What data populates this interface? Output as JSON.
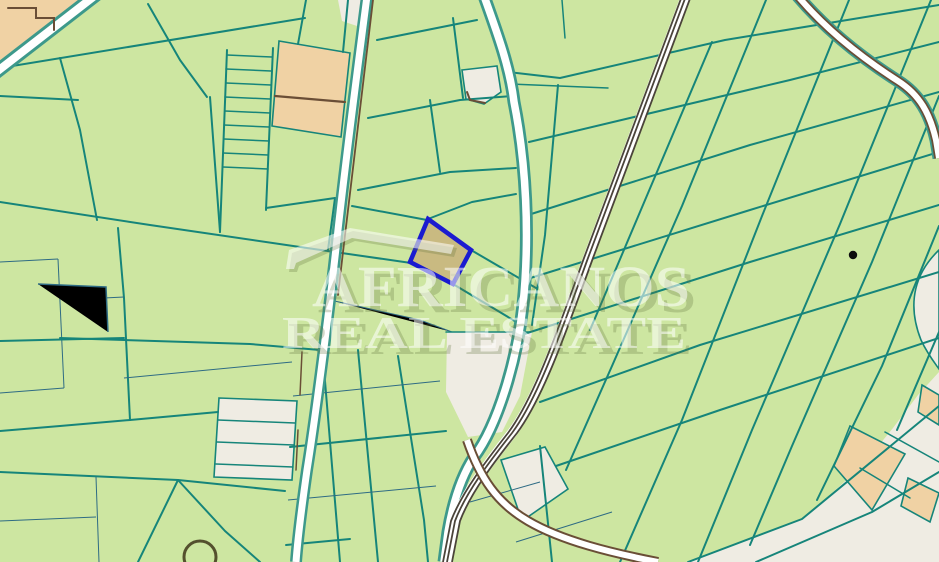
{
  "watermark": {
    "line1": "AFRICANOS",
    "line2": "REAL ESTATE",
    "logo": "house-roof-icon"
  },
  "map": {
    "kind": "cadastral-parcel-map",
    "highlighted_parcel": {
      "outline": "blue",
      "fill": "khaki",
      "approx_center_x": 441,
      "approx_center_y": 251
    }
  },
  "palette": {
    "land": "#cde6a1",
    "line": "#16857a",
    "line2": "#2e6b84",
    "urban": "#efece3",
    "tan": "#f0d2a4",
    "road": "#ffffff",
    "roadedge": "#3d998b",
    "brown": "#6a4e36",
    "rail": "#4b443a",
    "hifill": "#c9ba81",
    "histroke": "#1b1bd0",
    "dot": "#0d0d0d",
    "pond": "#54502e",
    "wmlight": "rgba(255,255,255,0.55)",
    "wmshadow": "rgba(96,115,60,0.28)"
  }
}
